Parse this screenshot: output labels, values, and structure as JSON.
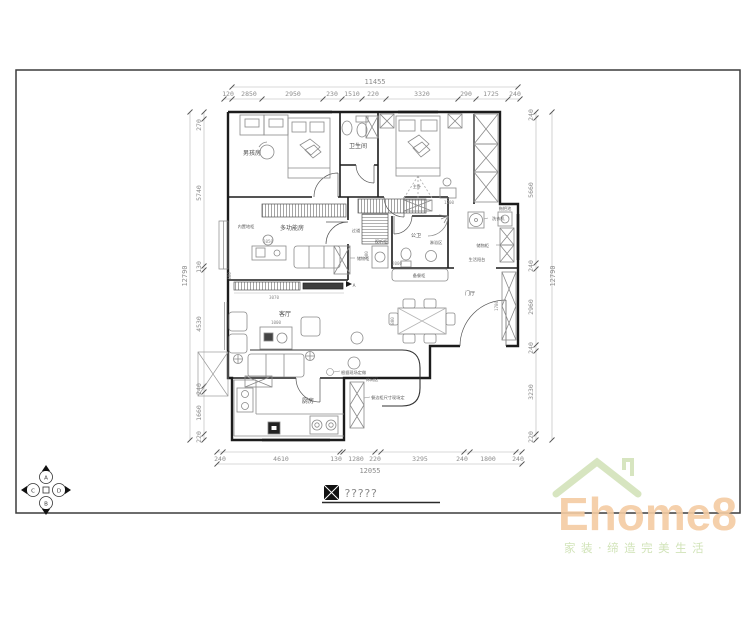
{
  "sheet": {
    "title_placeholder": "?????"
  },
  "dimensions": {
    "top": {
      "total": "11455",
      "segments": [
        "120",
        "2850",
        "2950",
        "230",
        "1510",
        "220",
        "3320",
        "290",
        "1725",
        "240"
      ]
    },
    "left": {
      "total": "12790",
      "segments": [
        "270",
        "5740",
        "130",
        "4530",
        "240",
        "1660",
        "220"
      ]
    },
    "right": {
      "total": "12790",
      "segments": [
        "240",
        "5660",
        "240",
        "2960",
        "240",
        "3230",
        "220"
      ]
    },
    "bottom": {
      "total": "12055",
      "segments": [
        "240",
        "4610",
        "130",
        "1280",
        "220",
        "3295",
        "240",
        "1800",
        "240"
      ]
    }
  },
  "room_labels": {
    "boy_room": "男孩房",
    "bathroom": "卫生间",
    "master_bedroom": "主卧",
    "multi_function_room": "多功能房",
    "built_in_cabinet": "内置地柜",
    "hallway": "过道",
    "hall_storage": "储物柜",
    "av_cabinet": "视听柜",
    "guest_bathroom": "公卫",
    "shower_area": "淋浴区",
    "washing_machine": "洗衣机",
    "mop_pool": "拖把池",
    "balcony_storage": "储物柜",
    "service_balcony": "生活阳台",
    "foyer": "门厅",
    "serving_cabinet": "备餐柜",
    "living_room": "客厅",
    "leisure_area": "休闲区",
    "kitchen": "厨房"
  },
  "inline_dimensions": {
    "desk": "1050",
    "tv_wall": "3070",
    "tv_wall_depth": "400",
    "coffee_table": "1000",
    "master_tv": "1200",
    "av_depth": "900",
    "av_length": "2000",
    "shoe_cabinet": "1780",
    "dining_table": "800"
  },
  "annotations": {
    "site_note": "根据现场定做",
    "cabinet_note": "餐边柜尺寸现场定"
  },
  "markers": {
    "compass_a": "A",
    "compass_b": "B",
    "compass_c": "C",
    "compass_d": "D",
    "elevation_a": "A"
  },
  "logo": {
    "brand": "Ehome8",
    "tagline": "家装·缔造完美生活",
    "brand_color": "#f4cba3",
    "roof_color": "#d7e5c0",
    "tagline_color": "#cfe2b5"
  }
}
